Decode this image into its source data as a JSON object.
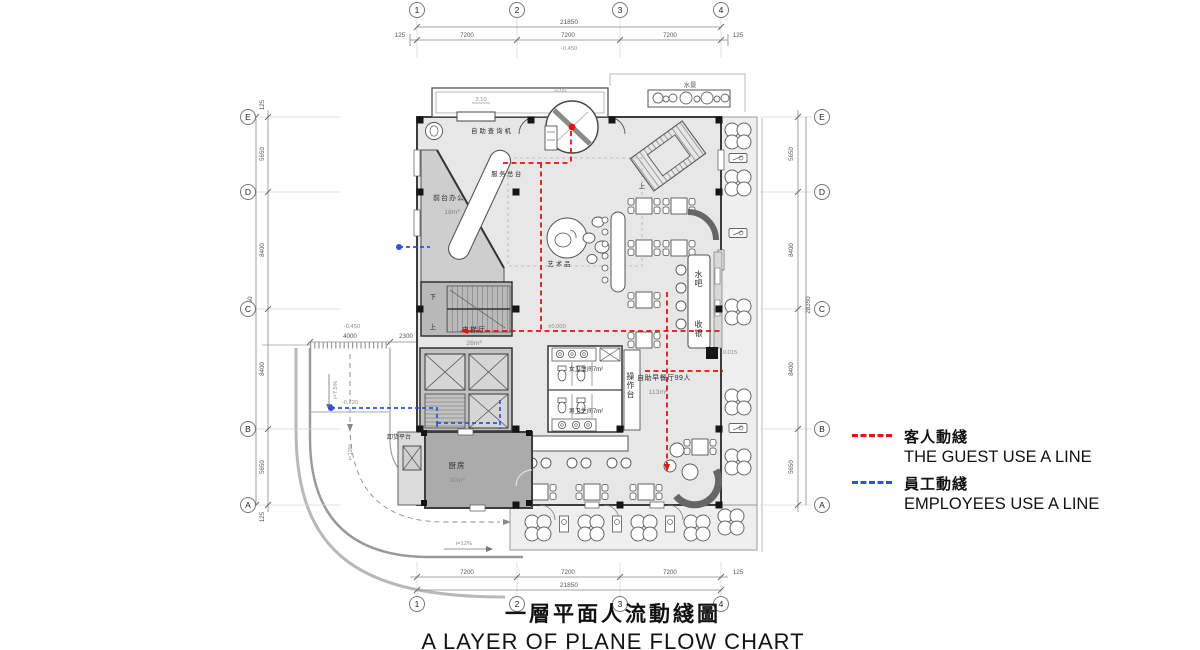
{
  "title": {
    "zh": "一層平面人流動綫圖",
    "en": "A LAYER OF PLANE FLOW CHART"
  },
  "legend": {
    "guest_zh": "客人動綫",
    "guest_en": "THE GUEST USE A LINE",
    "guest_color": "#e8110e",
    "employee_zh": "員工動綫",
    "employee_en": "EMPLOYEES USE A LINE",
    "employee_color": "#2d52e0"
  },
  "grid": {
    "cols": [
      "1",
      "2",
      "3",
      "4"
    ],
    "rows": [
      "E",
      "D",
      "C",
      "B",
      "A"
    ]
  },
  "dims": {
    "h_overall": "21850",
    "h_seg": "7200",
    "h_end": "125",
    "v_overall": "28350",
    "v_seg_outer": "5650",
    "v_seg_inner": "8400",
    "v_end": "125",
    "ramp_width": "4000",
    "ramp_offset": "2300"
  },
  "levels": {
    "site": "-0.450",
    "canopy": "3.10",
    "entry": "-0.05",
    "interior": "±0.000",
    "terrace": "-0.015",
    "ramp": "-0.720",
    "slope_ramp": "i=7.5%",
    "slope_drive": "i=12%"
  },
  "rooms": {
    "inquiry": "自助查询机",
    "reception": "服务总台",
    "office": "前台办公",
    "office_area": "18m²",
    "art": "艺术品",
    "lift_hall": "电梯厅",
    "lift_hall_area": "26m²",
    "wc_f": "女卫生间7m²",
    "wc_m": "男卫生间7m²",
    "counter": "操作台",
    "buffet": "自助早餐厅99人",
    "buffet_area": "113m²",
    "kitchen": "厨房",
    "kitchen_area": "30m²",
    "unloading": "卸货平台",
    "bar": "水吧",
    "cashier": "收银",
    "water": "水景",
    "up": "上",
    "down": "下"
  }
}
